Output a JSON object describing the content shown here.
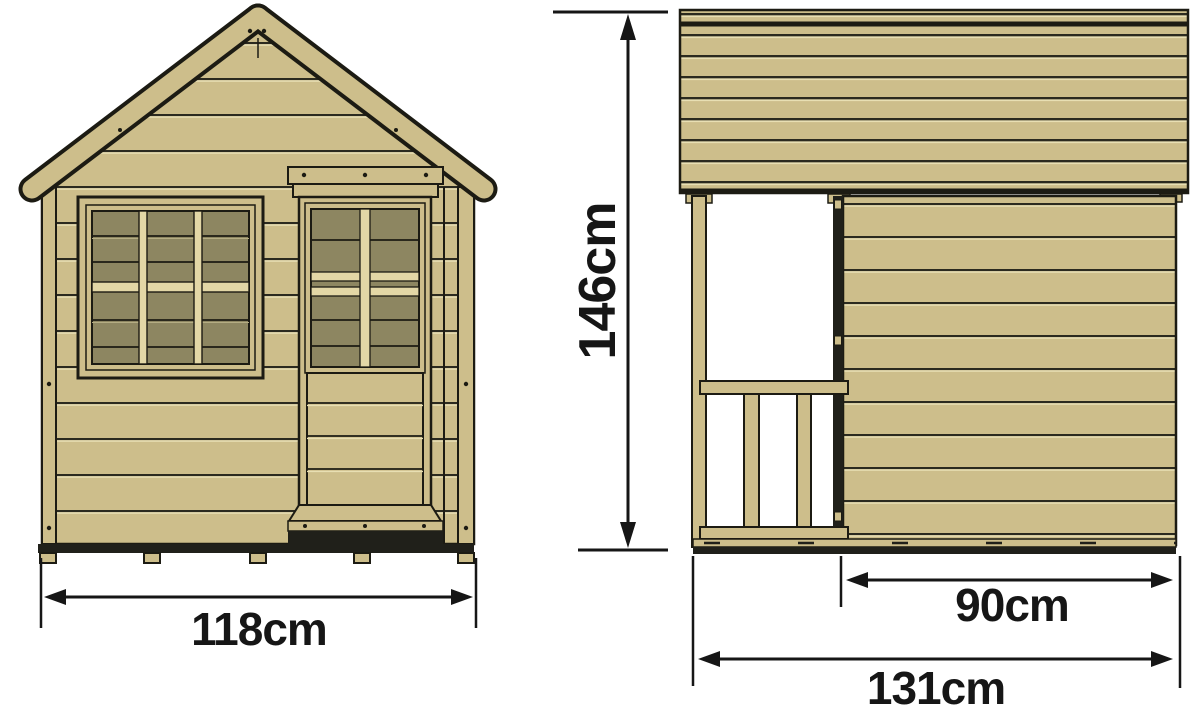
{
  "title": "Wooden playhouse dimension diagram",
  "views": {
    "front": {
      "width": {
        "label": "118cm",
        "value": 118,
        "unit": "cm"
      }
    },
    "side": {
      "height": {
        "label": "146cm",
        "value": 146,
        "unit": "cm"
      },
      "wall_depth": {
        "label": "90cm",
        "value": 90,
        "unit": "cm"
      },
      "total_depth": {
        "label": "131cm",
        "value": 131,
        "unit": "cm"
      }
    }
  },
  "colors": {
    "background": "#ffffff",
    "wood": "#cdbe8b",
    "wood_light": "#e3d7a6",
    "wood_highlight": "#e8dfb3",
    "glass": "#8d8661",
    "outline": "#1c1b13",
    "shadow": "#20201a",
    "dimension": "#161616"
  }
}
